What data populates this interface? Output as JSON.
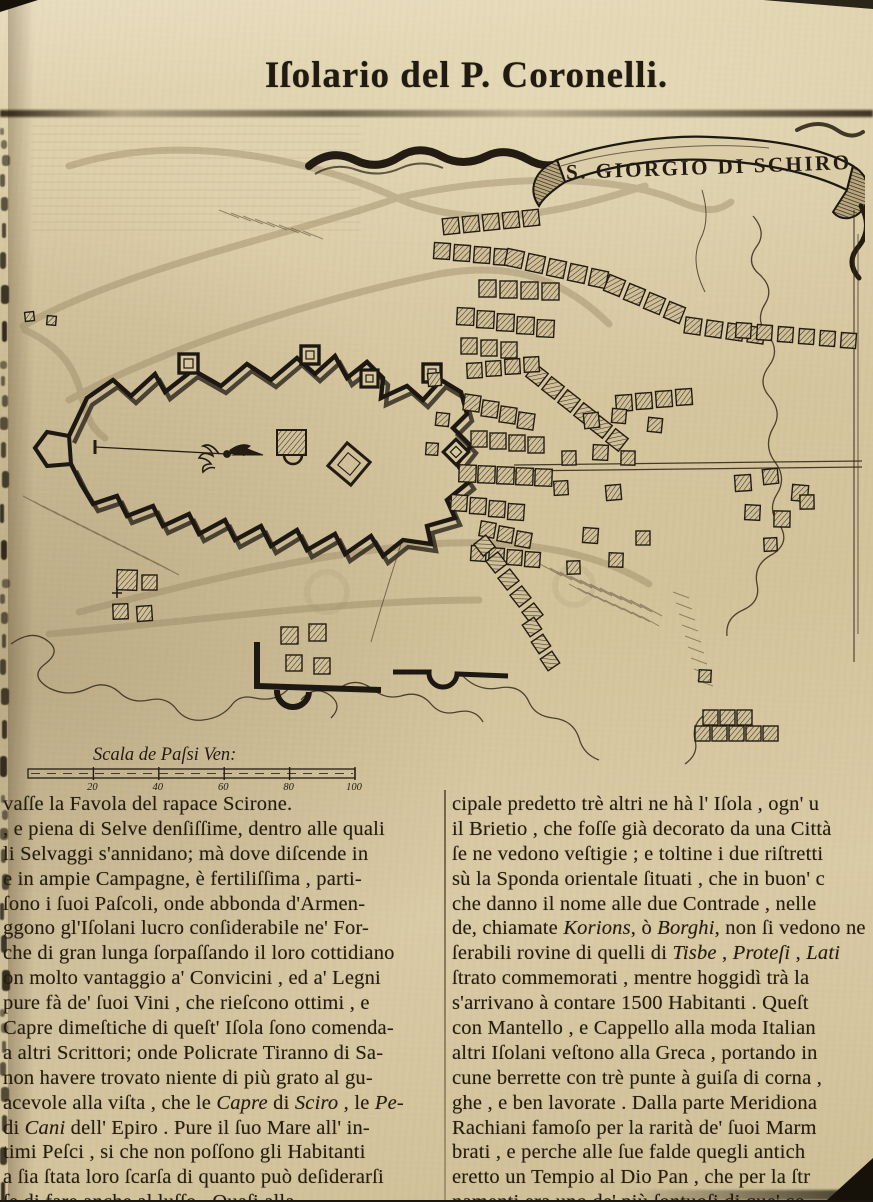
{
  "page": {
    "header_title": "Iſolario del P. Coronelli."
  },
  "map": {
    "banner_title": "S. GIORGIO DI SCHIRO",
    "scale": {
      "label": "Scala de Paſsi Ven:",
      "ticks": [
        "20",
        "40",
        "60",
        "80",
        "100"
      ]
    }
  },
  "columns": {
    "left": {
      "lines": [
        "vaſſe la Favola del rapace Scirone.",
        ", e piena di Selve denſiſſime, dentro alle quali",
        "li Selvaggi s'annidano;  mà dove diſcende in",
        "e in ampie Campagne, è fertiliſſima , parti-",
        "ſono i ſuoi Paſcoli,  onde abbonda d'Armen-",
        "ggono gl'Iſolani lucro conſiderabile ne' For-",
        "che di gran lunga ſorpaſſando il loro cottidiano",
        "on molto vantaggio a' Convicini , ed a' Legni",
        "pure fà de' ſuoi Vini ,  che rieſcono ottimi , e",
        "Capre dimeſtiche di queſt' Iſola ſono comenda-",
        "a altri Scrittori; onde Policrate Tiranno di Sa-",
        "non havere trovato niente di  più grato al gu-",
        [
          {
            "t": "acevole alla viſta ,  che le ",
            "i": false
          },
          {
            "t": "Capre",
            "i": true
          },
          {
            "t": " di ",
            "i": false
          },
          {
            "t": "Sciro",
            "i": true
          },
          {
            "t": " , le ",
            "i": false
          },
          {
            "t": "Pe-",
            "i": true
          }
        ],
        [
          {
            "t": "di ",
            "i": false
          },
          {
            "t": "Cani",
            "i": true
          },
          {
            "t": " dell' Epiro .  Pure il ſuo Mare all' in-",
            "i": false
          }
        ],
        "timi Peſci , si che non poſſono gli  Habitanti",
        "a ſia ſtata loro ſcarſa di quanto può deſiderarſi",
        "ſe di fare anche al luſſo .  Quaſi alla"
      ]
    },
    "right": {
      "lines": [
        "cipale predetto trè altri ne hà l' Iſola ,  ogn' u",
        "il Brietio ,  che foſſe già decorato da una Città",
        "ſe ne vedono veſtigie ; e toltine i due riſtretti",
        "sù la Sponda orientale ſituati , che in buon' c",
        "che danno il nome alle due  Contrade ,  nelle",
        [
          {
            "t": "de, chiamate ",
            "i": false
          },
          {
            "t": "Korions",
            "i": true
          },
          {
            "t": ", ò ",
            "i": false
          },
          {
            "t": "Borghi",
            "i": true
          },
          {
            "t": ", non ſi vedono ne",
            "i": false
          }
        ],
        [
          {
            "t": "ſerabili rovine di quelli di ",
            "i": false
          },
          {
            "t": "Tisbe",
            "i": true
          },
          {
            "t": " , ",
            "i": false
          },
          {
            "t": "Proteſi",
            "i": true
          },
          {
            "t": " , ",
            "i": false
          },
          {
            "t": "Lati",
            "i": true
          }
        ],
        "ſtrato commemorati ,  mentre hoggidì trà la",
        "s'arrivano à contare  1500  Habitanti .  Queſt",
        "con  Mantello ,  e Cappello alla moda Italian",
        "altri  Iſolani  veſtono  alla  Greca ,  portando in",
        "cune berrette  con trè  punte à guiſa di corna ,",
        "ghe ,  e ben lavorate .  Dalla parte Meridiona",
        "Rachiani famoſo  per  la rarità de' ſuoi  Marm",
        "brati ,  e perche alle  ſue  falde quegli antich",
        "eretto un  Tempio al Dio Pan ,  che per la ſtr",
        "namenti era uno de' più ſontuoſi di que' co"
      ]
    }
  }
}
